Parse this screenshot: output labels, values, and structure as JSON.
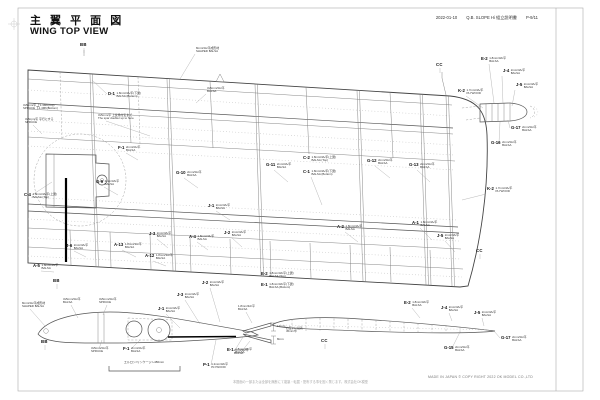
{
  "header": {
    "title_jp": "主 翼 平 面 図",
    "title_en": "WING TOP VIEW",
    "date": "2022-01-10",
    "doc": "Q.B. SLOPE Hi 組立説明書",
    "page": "P-9/11"
  },
  "footer": {
    "disclaimer": "本図面の一部または全部を無断にて複製・転載・配布する事を固く禁じます。株式会社OK模型",
    "made": "MADE IN JAPAN   © COPY RIGHT 2022   OK MODEL CO.,LTD"
  },
  "dim": {
    "aileron": "エルロン/リンケージ L480mm",
    "d12": "12mm",
    "d8": "8mm",
    "note1": "お互いに接着",
    "note2": "45mm巾"
  },
  "markers": [
    {
      "t": "BB",
      "x": 80,
      "y": 42
    },
    {
      "t": "BB",
      "x": 53,
      "y": 278
    },
    {
      "t": "BB",
      "x": 41,
      "y": 339
    },
    {
      "t": "CC",
      "x": 436,
      "y": 62
    },
    {
      "t": "CC",
      "x": 476,
      "y": 248
    },
    {
      "t": "CC",
      "x": 321,
      "y": 338
    }
  ],
  "callouts": [
    {
      "id": "D-1",
      "s": "1.8mm/3A/平(下翼)",
      "m": "BALSA (Bottom)",
      "x": 108,
      "y": 92,
      "tx": 92,
      "ty": 80
    },
    {
      "id": "",
      "s": "3x5mm/平 上1.4M6(Top)",
      "m": "SPRUCE 下1.4M6(Bottom)",
      "x": 23,
      "y": 104
    },
    {
      "id": "",
      "s": "3x5mm/平 平行にする",
      "m": "SPRUCE",
      "x": 25,
      "y": 118,
      "tx": 42,
      "ty": 134
    },
    {
      "id": "",
      "s": "3x5mm/平 上反角付近まで",
      "m": "The spar doubler up to here",
      "x": 98,
      "y": 114,
      "tx": 150,
      "ty": 136
    },
    {
      "id": "F-1",
      "s": "2mm/3A/平",
      "m": "BALSA",
      "x": 118,
      "y": 146,
      "tx": 138,
      "ty": 160
    },
    {
      "id": "G-9",
      "s": "2mm/3A/平",
      "m": "BALSA",
      "x": 96,
      "y": 180,
      "tx": 118,
      "ty": 195
    },
    {
      "id": "C-4",
      "s": "1.8mm/3A/平(上翼)",
      "m": "BALSA (Top)",
      "x": 24,
      "y": 193,
      "tx": 52,
      "ty": 182
    },
    {
      "id": "G-10",
      "s": "2mm/3A/平",
      "m": "BALSA",
      "x": 176,
      "y": 171,
      "tx": 198,
      "ty": 188
    },
    {
      "id": "G-11",
      "s": "2mm/3A/平",
      "m": "BALSA",
      "x": 266,
      "y": 163,
      "tx": 288,
      "ty": 182
    },
    {
      "id": "C-2",
      "s": "1.8mm/3A/平(上翼)",
      "m": "BALSA (Top)",
      "x": 303,
      "y": 156
    },
    {
      "id": "C-1",
      "s": "1.8mm/3A/平(下翼)",
      "m": "BALSA (Bottom)",
      "x": 303,
      "y": 170,
      "tx": 322,
      "ty": 205
    },
    {
      "id": "G-12",
      "s": "2mm/3A/平",
      "m": "BALSA",
      "x": 367,
      "y": 159,
      "tx": 390,
      "ty": 178
    },
    {
      "id": "G-13",
      "s": "2mm/3A/平",
      "m": "BALSA",
      "x": 409,
      "y": 163,
      "tx": 430,
      "ty": 182
    },
    {
      "id": "J-1",
      "s": "2mm/3A/平",
      "m": "BALSA",
      "x": 208,
      "y": 204,
      "tx": 230,
      "ty": 220
    },
    {
      "id": "K-2",
      "s": "1.7mm/3A/平",
      "m": "PLYWOOD",
      "x": 487,
      "y": 187,
      "tx": 462,
      "ty": 200
    },
    {
      "id": "A-2",
      "s": "1.8mm/3A/平",
      "m": "BALSA",
      "x": 337,
      "y": 225,
      "tx": 358,
      "ty": 242
    },
    {
      "id": "A-1",
      "s": "1.8mm/3A/平",
      "m": "BALSA",
      "x": 412,
      "y": 221,
      "tx": 432,
      "ty": 240
    },
    {
      "id": "J-5",
      "s": "2mm/3A/平",
      "m": "BALSA",
      "x": 437,
      "y": 234,
      "tx": 455,
      "ty": 252
    },
    {
      "id": "A-4",
      "s": "1.8mm/3A/平",
      "m": "BALSA",
      "x": 189,
      "y": 235,
      "tx": 208,
      "ty": 250
    },
    {
      "id": "J-2",
      "s": "2mm/3A/平",
      "m": "BALSA",
      "x": 224,
      "y": 231,
      "tx": 242,
      "ty": 247
    },
    {
      "id": "J-3",
      "s": "2mm/3A/平",
      "m": "BALSA",
      "x": 149,
      "y": 232,
      "tx": 168,
      "ty": 248
    },
    {
      "id": "A-13",
      "s": "1.8mm/3A/平",
      "m": "BALSA",
      "x": 114,
      "y": 243,
      "tx": 136,
      "ty": 257
    },
    {
      "id": "A-12",
      "s": "1.8mm/3A/平",
      "m": "BALSA",
      "x": 145,
      "y": 254,
      "tx": 166,
      "ty": 266
    },
    {
      "id": "J-6",
      "s": "2mm/3A/平",
      "m": "BALSA",
      "x": 66,
      "y": 244,
      "tx": 86,
      "ty": 257
    },
    {
      "id": "A-5",
      "s": "1.8mm/3A/平",
      "m": "BALSA",
      "x": 33,
      "y": 264,
      "tx": 54,
      "ty": 272
    },
    {
      "id": "",
      "s": "8mm/3A/平成形材",
      "m": "SHAPED BALSA",
      "x": 196,
      "y": 47,
      "tx": 180,
      "ty": 79
    },
    {
      "id": "",
      "s": "3x5mm/3A/平",
      "m": "BALSA",
      "x": 207,
      "y": 87,
      "tx": 196,
      "ty": 103
    },
    {
      "id": "E-2",
      "s": "1.8mm/3A/平",
      "m": "BALSA",
      "x": 481,
      "y": 57,
      "tx": 494,
      "ty": 103
    },
    {
      "id": "J-4",
      "s": "2mm/3A/平",
      "m": "BALSA",
      "x": 503,
      "y": 69,
      "tx": 503,
      "ty": 104
    },
    {
      "id": "J-5",
      "s": "2mm/3A/平",
      "m": "BALSA",
      "x": 516,
      "y": 83,
      "tx": 512,
      "ty": 106
    },
    {
      "id": "K-2",
      "s": "1.7mm/3A/平",
      "m": "PLYWOOD",
      "x": 458,
      "y": 89,
      "tx": 483,
      "ty": 108
    },
    {
      "id": "G-17",
      "s": "2mm/3A/平",
      "m": "BALSA",
      "x": 511,
      "y": 126,
      "tx": 508,
      "ty": 120
    },
    {
      "id": "G-16",
      "s": "2mm/3A/平",
      "m": "BALSA",
      "x": 491,
      "y": 141,
      "tx": 500,
      "ty": 122
    },
    {
      "id": "E-2",
      "s": "1.8mm/3A/平(上翼)",
      "m": "BALSA (Top)",
      "x": 261,
      "y": 272
    },
    {
      "id": "E-1",
      "s": "1.8mm/3A/平(下翼)",
      "m": "BALSA (Bottom)",
      "x": 261,
      "y": 283
    },
    {
      "id": "",
      "s": "8mm/3A/平成形材",
      "m": "SHAPED BALSA",
      "x": 22,
      "y": 302,
      "tx": 45,
      "ty": 326
    },
    {
      "id": "",
      "s": "3x5mm/3A/平",
      "m": "BALSA",
      "x": 63,
      "y": 298,
      "tx": 78,
      "ty": 318
    },
    {
      "id": "",
      "s": "3x5mm/3A/平",
      "m": "SPRUCE",
      "x": 99,
      "y": 298,
      "tx": 103,
      "ty": 315
    },
    {
      "id": "J-2",
      "s": "2mm/3A/平",
      "m": "BALSA",
      "x": 202,
      "y": 281,
      "tx": 220,
      "ty": 322
    },
    {
      "id": "J-3",
      "s": "2mm/3A/平",
      "m": "BALSA",
      "x": 177,
      "y": 293,
      "tx": 200,
      "ty": 324
    },
    {
      "id": "J-1",
      "s": "2mm/3A/平",
      "m": "BALSA",
      "x": 158,
      "y": 307,
      "tx": 180,
      "ty": 328
    },
    {
      "id": "",
      "s": "3x5mm/3A/平",
      "m": "SPRUCE",
      "x": 91,
      "y": 347,
      "tx": 102,
      "ty": 340
    },
    {
      "id": "F-1",
      "s": "2mm/3A/平",
      "m": "BALSA",
      "x": 123,
      "y": 347,
      "tx": 140,
      "ty": 340
    },
    {
      "id": "E-1",
      "s": "1.8mm/3A/平",
      "m": "BALSA",
      "x": 227,
      "y": 348,
      "tx": 243,
      "ty": 337
    },
    {
      "id": "P-1",
      "s": "1.2mm/3A/平",
      "m": "PLYWOOD",
      "x": 203,
      "y": 363,
      "tx": 216,
      "ty": 340
    },
    {
      "id": "",
      "s": "1.8mm/3A/平",
      "m": "BALSA",
      "x": 238,
      "y": 305,
      "tx": 252,
      "ty": 323
    },
    {
      "id": "",
      "s": "2mm/3A/平",
      "m": "BALSA",
      "x": 234,
      "y": 349,
      "tx": 250,
      "ty": 341
    },
    {
      "id": "E-2",
      "s": "1.8mm/3A/平",
      "m": "BALSA",
      "x": 404,
      "y": 301,
      "tx": 420,
      "ty": 318
    },
    {
      "id": "J-4",
      "s": "2mm/3A/平",
      "m": "BALSA",
      "x": 441,
      "y": 306,
      "tx": 452,
      "ty": 321
    },
    {
      "id": "J-5",
      "s": "2mm/3A/平",
      "m": "BALSA",
      "x": 474,
      "y": 311,
      "tx": 484,
      "ty": 326
    },
    {
      "id": "G-17",
      "s": "2mm/3A/平",
      "m": "BALSA",
      "x": 501,
      "y": 336,
      "tx": 494,
      "ty": 331
    },
    {
      "id": "G-15",
      "s": "2mm/3A/平",
      "m": "BALSA",
      "x": 444,
      "y": 346,
      "tx": 460,
      "ty": 332
    }
  ]
}
